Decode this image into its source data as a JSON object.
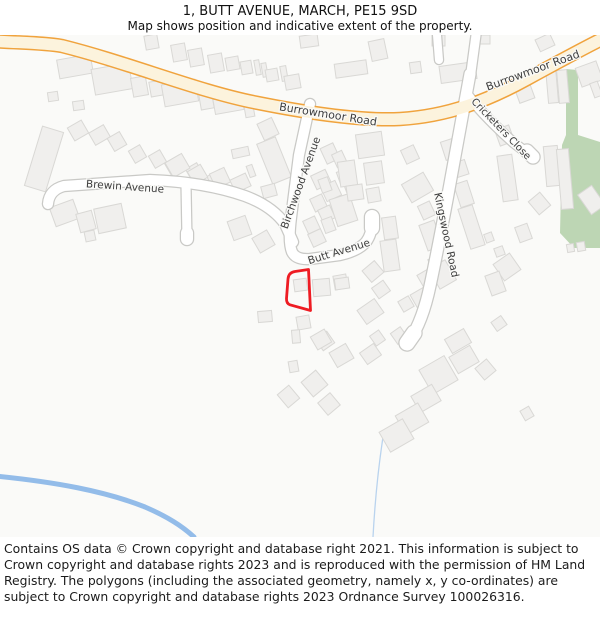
{
  "page": {
    "title": "1, BUTT AVENUE, MARCH, PE15 9SD",
    "subtitle": "Map shows position and indicative extent of the property."
  },
  "map": {
    "road_labels": {
      "burrowmoor_west": "Burrowmoor Road",
      "burrowmoor_east": "Burrowmoor Road",
      "brewin": "Brewin Avenue",
      "birchwood": "Birchwood Avenue",
      "butt": "Butt Avenue",
      "kingswood": "Kingswood Road",
      "cricketers": "Cricketers Close"
    },
    "colors": {
      "background": "#fafaf8",
      "building_fill": "#f0efed",
      "building_stroke": "#d9d8d5",
      "road_casing": "#c9c9c6",
      "road_fill": "#ffffff",
      "primary_casing": "#f0a33d",
      "primary_fill": "#fcf3dd",
      "green": "#bdd6b4",
      "water": "#93bce9",
      "stream": "#b9d3ee",
      "label": "#3d3d3d",
      "property_outline": "#ee1c23"
    }
  },
  "footer": {
    "copyright": "Contains OS data © Crown copyright and database right 2021. This information is subject to Crown copyright and database rights 2023 and is reproduced with the permission of HM Land Registry. The polygons (including the associated geometry, namely x, y co-ordinates) are subject to Crown copyright and database rights 2023 Ordnance Survey 100026316."
  }
}
